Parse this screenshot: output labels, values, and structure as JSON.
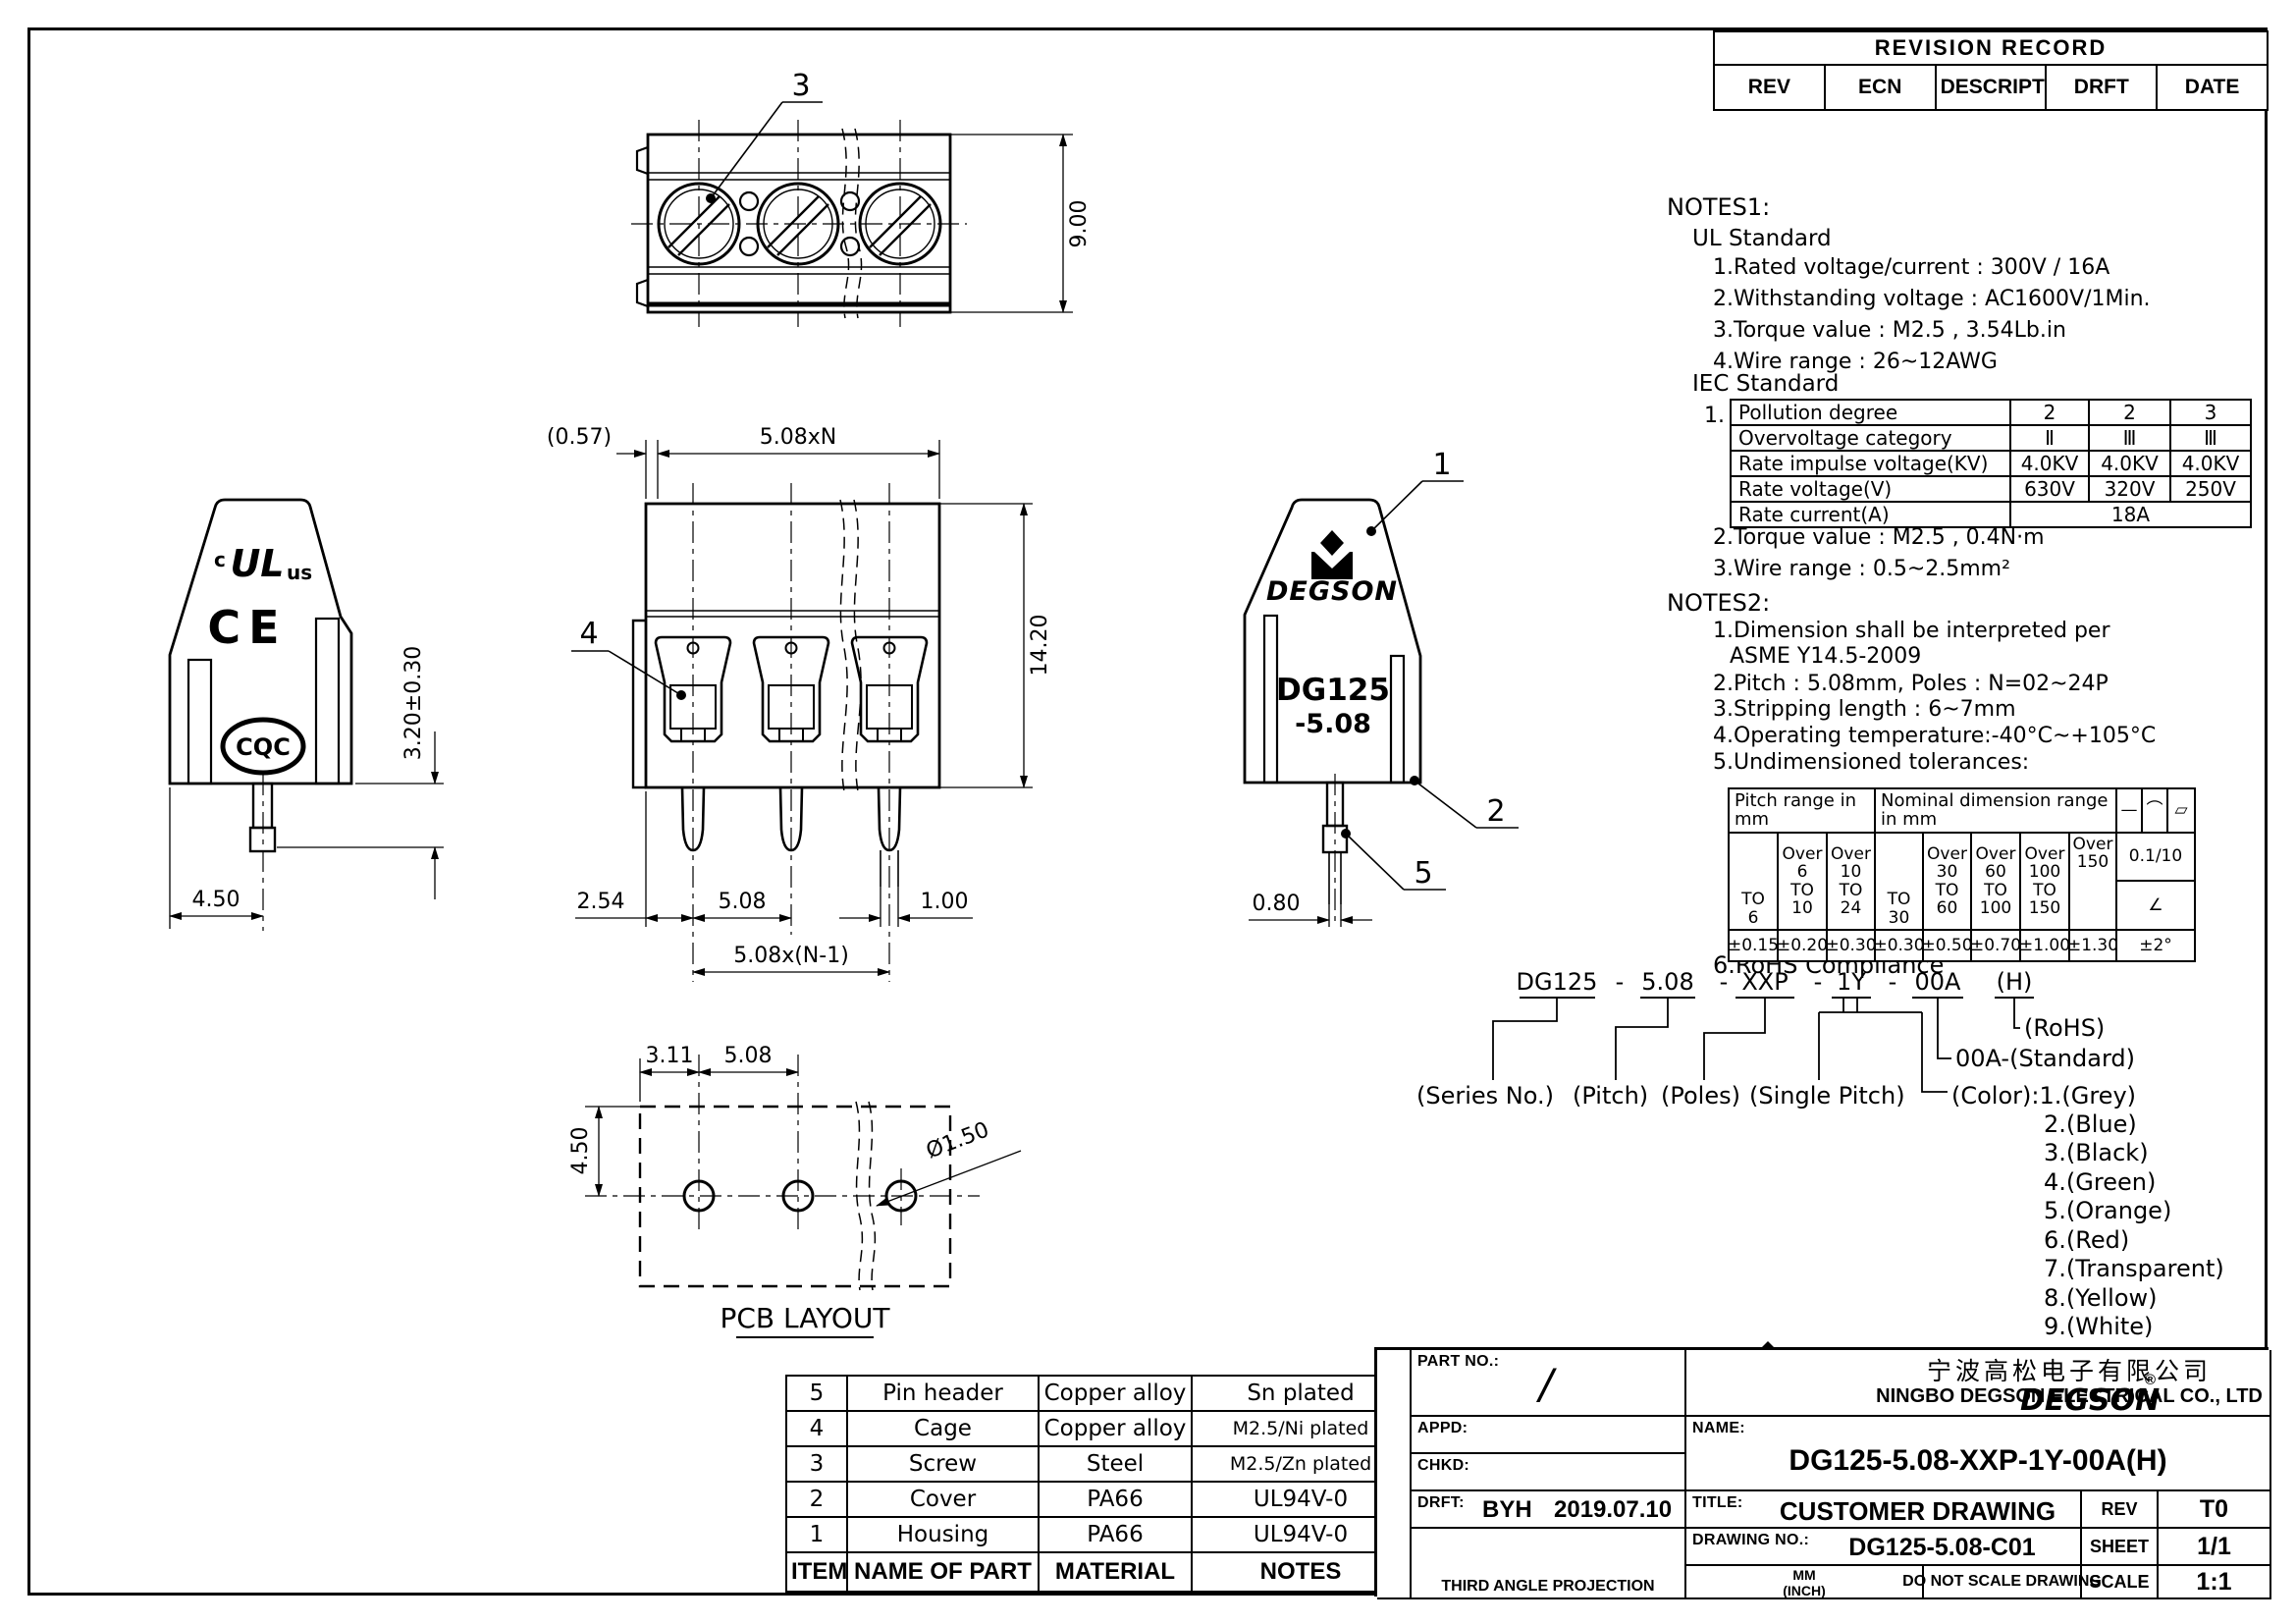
{
  "sheet": {
    "paper": "#ffffff",
    "ink": "#000000"
  },
  "revision_record": {
    "title": "REVISION RECORD",
    "columns": [
      "REV",
      "ECN",
      "DESCRIPTION",
      "DRFT",
      "DATE"
    ]
  },
  "notes1": {
    "heading": "NOTES1:",
    "ul": {
      "heading": "UL Standard",
      "items": [
        "1.Rated voltage/current : 300V / 16A",
        "2.Withstanding voltage : AC1600V/1Min.",
        "3.Torque value : M2.5 , 3.54Lb.in",
        "4.Wire range : 26~12AWG"
      ]
    },
    "iec": {
      "heading": "IEC Standard",
      "item_prefix": "1.",
      "table": {
        "rows": [
          [
            "Pollution degree",
            "2",
            "2",
            "3"
          ],
          [
            "Overvoltage category",
            "Ⅱ",
            "Ⅲ",
            "Ⅲ"
          ],
          [
            "Rate impulse voltage(KV)",
            "4.0KV",
            "4.0KV",
            "4.0KV"
          ],
          [
            "Rate voltage(V)",
            "630V",
            "320V",
            "250V"
          ]
        ],
        "current_label": "Rate current(A)",
        "current_value": "18A"
      },
      "items": [
        "2.Torque value : M2.5 , 0.4N·m",
        "3.Wire range : 0.5~2.5mm²"
      ]
    }
  },
  "notes2": {
    "heading": "NOTES2:",
    "item1a": "1.Dimension shall be interpreted per",
    "item1b": "ASME Y14.5-2009",
    "item2": "2.Pitch : 5.08mm, Poles : N=02~24P",
    "item3": "3.Stripping length : 6~7mm",
    "item4": "4.Operating temperature:-40°C~+105°C",
    "item5": "5.Undimensioned tolerances:",
    "item6": "6.RoHS Compliance"
  },
  "tolerance": {
    "pitch_header": "Pitch range in\nmm",
    "nominal_header": "Nominal dimension range\nin mm",
    "symbols": [
      "—",
      "⌒",
      "▱"
    ],
    "ranges": [
      "TO\n6",
      "Over\n6\nTO\n10",
      "Over\n10\nTO\n24",
      "TO\n30",
      "Over\n30\nTO\n60",
      "Over\n60\nTO\n100",
      "Over\n100\nTO\n150",
      "Over\n150"
    ],
    "values": [
      "±0.15",
      "±0.20",
      "±0.30",
      "±0.30",
      "±0.50",
      "±0.70",
      "±1.00",
      "±1.30"
    ],
    "right": [
      "0.1/10",
      "∠",
      "±2°"
    ]
  },
  "ordering": {
    "code": [
      "DG125",
      "5.08",
      "XXP",
      "1Y",
      "00A",
      "(H)"
    ],
    "dash": "-",
    "rohs": "(RoHS)",
    "standard": "00A-(Standard)",
    "labels": [
      "(Series No.)",
      "(Pitch)",
      "(Poles)",
      "(Single Pitch)"
    ],
    "color_label": "(Color):1.(Grey)",
    "colors": [
      "2.(Blue)",
      "3.(Black)",
      "4.(Green)",
      "5.(Orange)",
      "6.(Red)",
      "7.(Transparent)",
      "8.(Yellow)",
      "9.(White)"
    ]
  },
  "parts": {
    "rows": [
      [
        "5",
        "Pin header",
        "Copper alloy",
        "Sn plated"
      ],
      [
        "4",
        "Cage",
        "Copper alloy",
        "M2.5/Ni plated"
      ],
      [
        "3",
        "Screw",
        "Steel",
        "M2.5/Zn plated"
      ],
      [
        "2",
        "Cover",
        "PA66",
        "UL94V-0"
      ],
      [
        "1",
        "Housing",
        "PA66",
        "UL94V-0"
      ]
    ],
    "header": [
      "ITEM",
      "NAME OF PART",
      "MATERIAL",
      "NOTES"
    ],
    "side_label": "DETACHED LISTS"
  },
  "title_block": {
    "part_no_label": "PART NO.:",
    "part_no_value": "/",
    "appd_label": "APPD:",
    "chkd_label": "CHKD:",
    "drft_label": "DRFT:",
    "drft_name": "BYH",
    "drft_date": "2019.07.10",
    "projection_label": "THIRD ANGLE PROJECTION",
    "brand": "DEGSON",
    "brand_reg": "®",
    "company_cn": "宁波高松电子有限公司",
    "company_en": "NINGBO DEGSON ELECTRICAL CO., LTD",
    "name_label": "NAME:",
    "name_value": "DG125-5.08-XXP-1Y-00A(H)",
    "title_label": "TITLE:",
    "title_value": "CUSTOMER DRAWING",
    "rev_label": "REV",
    "rev_value": "T0",
    "drawing_no_label": "DRAWING NO.:",
    "drawing_no_value": "DG125-5.08-C01",
    "sheet_label": "SHEET",
    "sheet_value": "1/1",
    "unit_top": "MM",
    "unit_bottom": "(INCH)",
    "scale_note": "DO NOT SCALE DRAWING",
    "scale_label": "SCALE",
    "scale_value": "1:1"
  },
  "views": {
    "top": {
      "balloon": "3",
      "dim_height": "9.00"
    },
    "front": {
      "dim_overhang": "(0.57)",
      "dim_pitch_total": "5.08xN",
      "dim_body_height": "14.20",
      "balloon": "4",
      "dim_half_pitch": "2.54",
      "dim_pitch": "5.08",
      "dim_pin_width": "1.00",
      "dim_span": "5.08x(N-1)"
    },
    "side": {
      "ul_c": "c",
      "ul_mark": "UL",
      "ul_us": "us",
      "ce_mark": "CE",
      "cqc_mark": "CQC",
      "dim_pin_len": "3.20±0.30",
      "dim_depth": "4.50"
    },
    "pole": {
      "balloon_cover": "1",
      "balloon_housing": "2",
      "balloon_pin": "5",
      "brand": "DEGSON",
      "series": "DG125",
      "pitch": "-5.08",
      "dim_wire": "0.80"
    },
    "pcb": {
      "dim_offset": "3.11",
      "dim_pitch": "5.08",
      "dim_row": "4.50",
      "dim_hole": "Ø1.50",
      "caption": "PCB LAYOUT"
    }
  }
}
